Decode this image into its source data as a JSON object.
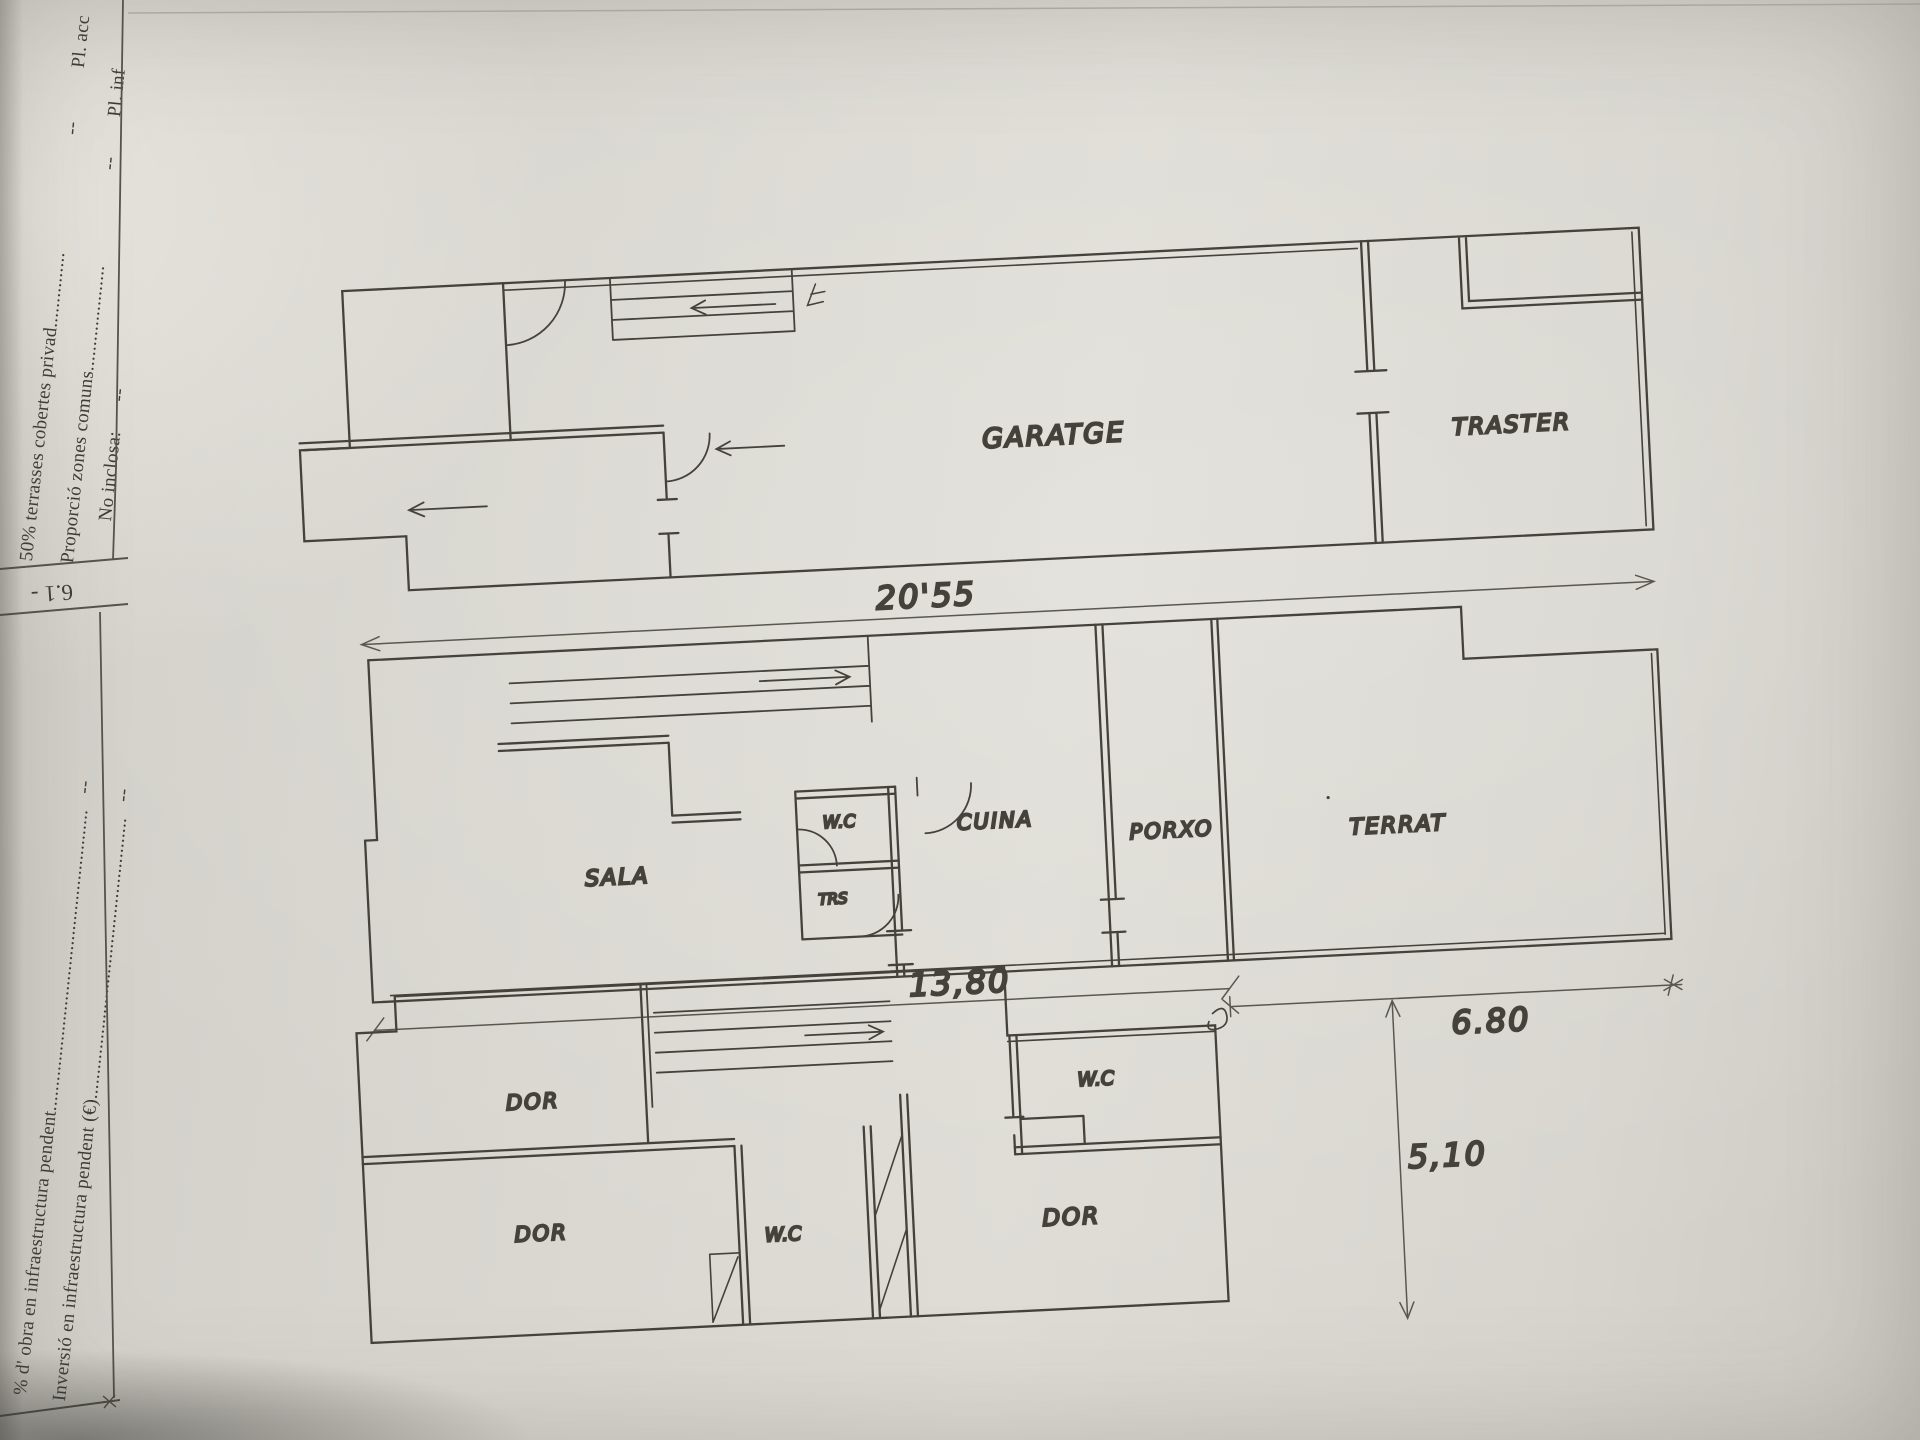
{
  "form": {
    "section_number": "6.1 -",
    "rows": [
      {
        "label": "50% terrasses cobertes privad...............",
        "value": "--",
        "col2": "Pl. acc"
      },
      {
        "label": "Proporció zones comuns.....................",
        "value": "--",
        "col2": "Pl. inf"
      },
      {
        "label": "No inclosa:",
        "value": "--"
      },
      {
        "label": "% d' obra en infraestructura pendent............................................................",
        "value": "--"
      },
      {
        "label": "Inversió en infraestructura pendent (€)........................................................",
        "value": "--"
      }
    ]
  },
  "plans": {
    "plan_top": {
      "rooms": {
        "garage": "GARATGE",
        "storage": "TRASTER"
      },
      "dimension_width": "20'55"
    },
    "plan_middle": {
      "rooms": {
        "living": "SALA",
        "wc": "W.C",
        "storage": "TRS",
        "kitchen": "CUINA",
        "porch": "PORXO",
        "terrace": "TERRAT"
      },
      "dimension_left": "13,80",
      "dimension_right": "6.80"
    },
    "plan_bottom": {
      "rooms": {
        "bedroom1": "DOR",
        "bedroom2": "DOR",
        "wc1": "W.C",
        "bedroom3": "DOR",
        "wc2": "W.C"
      },
      "dimension_height": "5,10"
    }
  },
  "colors": {
    "paper": "#d8d6cf",
    "ink": "#44423a",
    "print_text": "#3d3c36"
  }
}
